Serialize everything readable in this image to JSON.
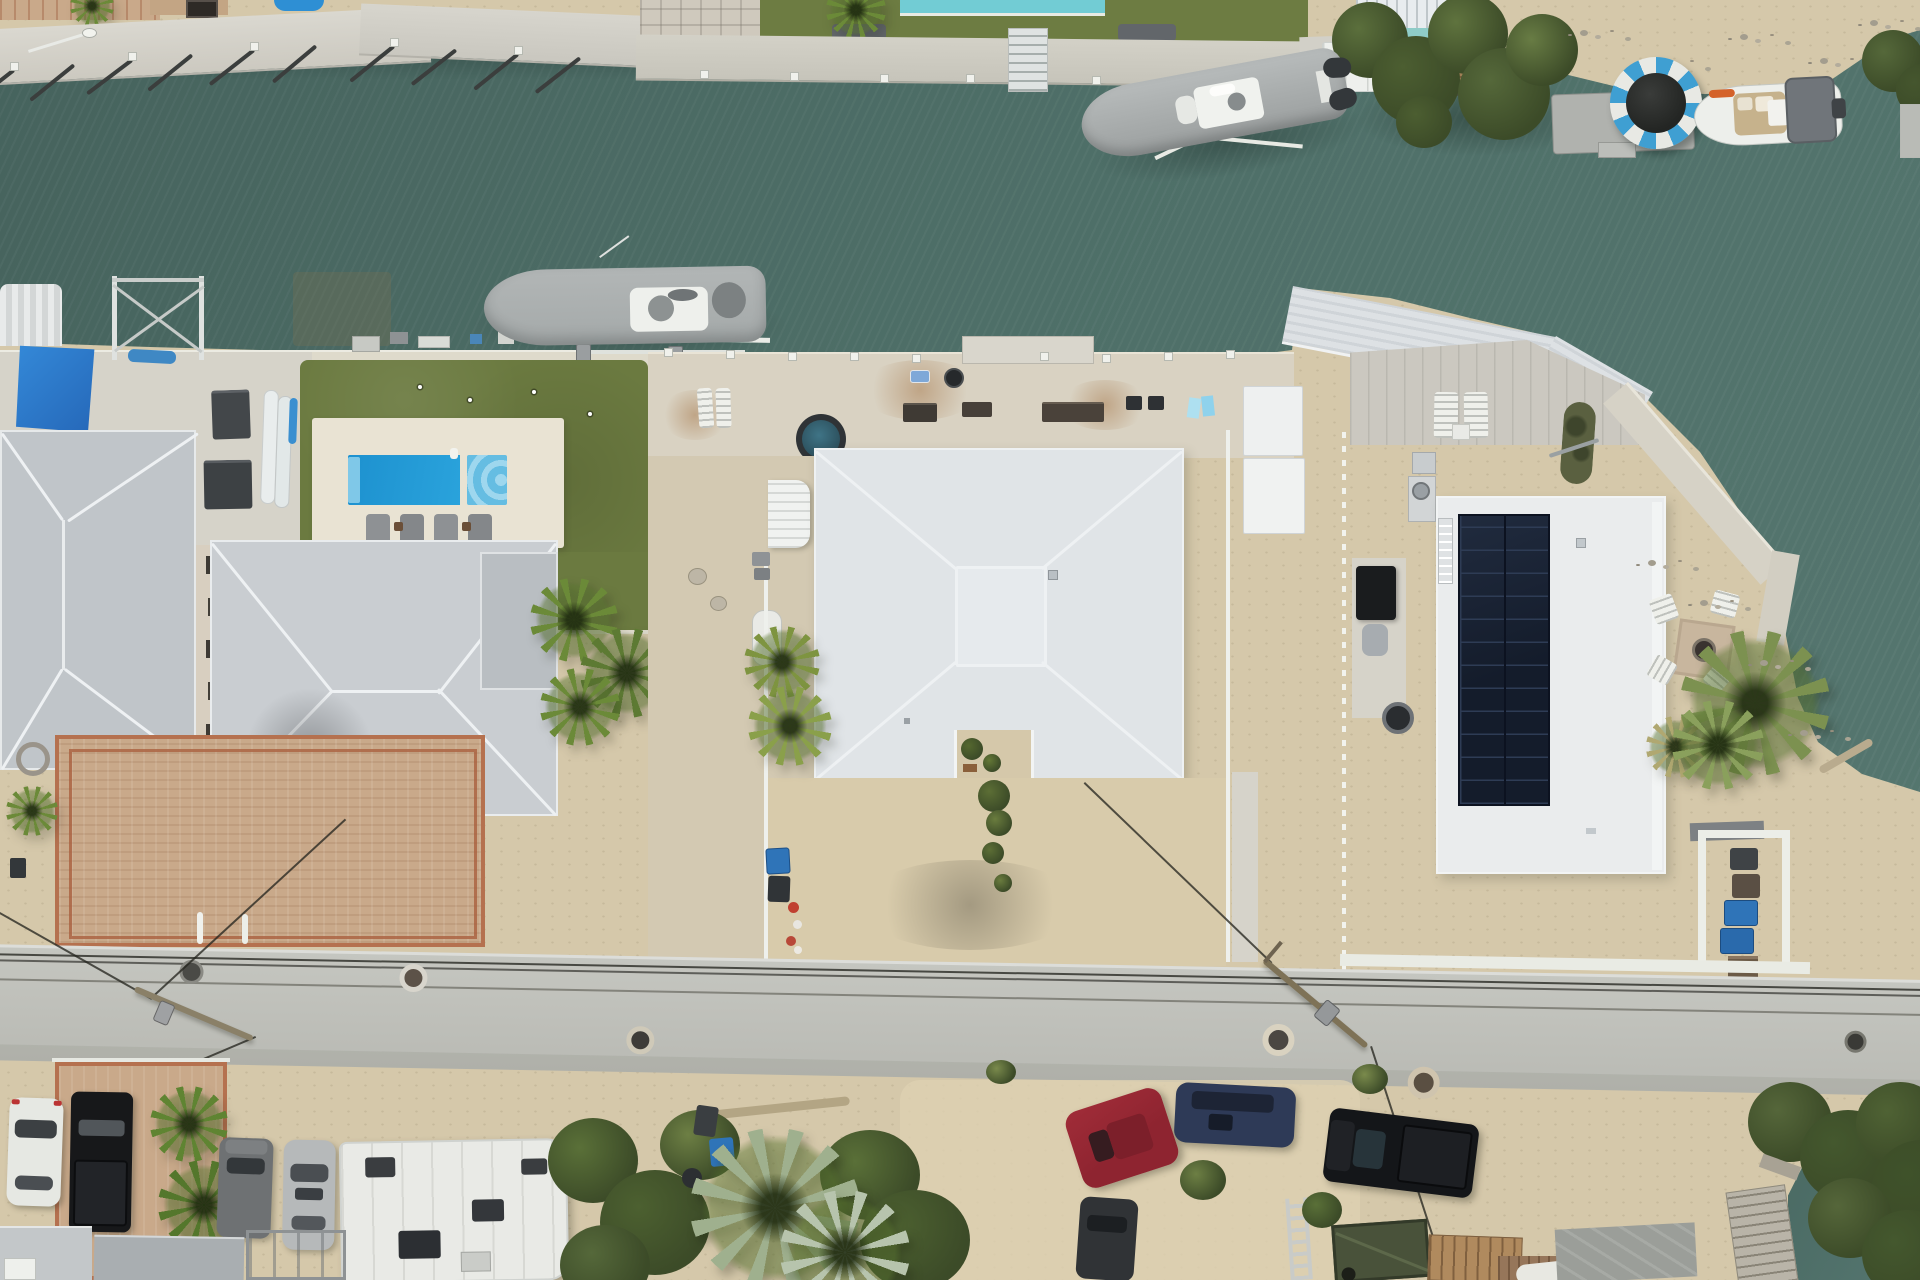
{
  "scene": {
    "kind": "aerial-drone-photo",
    "setting": "waterfront canal neighborhood with three properties, docks, boats, pool, solar roof, road and parked vehicles"
  },
  "palette": {
    "water": "#4e6f68",
    "waterDark": "#46635d",
    "waterLight": "#567770",
    "sand": "#d5c8aa",
    "sandBright": "#ddd1b2",
    "gravel": "#cdc3ad",
    "concrete": "#d9d2c2",
    "seawall": "#d6d3c9",
    "poolDeck": "#e9e3d3",
    "road": "#c5c6c0",
    "turf": "#6b7a40",
    "lawn": "#6d7c42",
    "pool": "#2196d2",
    "spa": "#65bde2",
    "neighborPool": "#72ccd4",
    "shadeSail": "#2b7fd0",
    "roofGray": "#c0c5c9",
    "roofGrayLight": "#c9cdd1",
    "roofWhite": "#e0e4e7",
    "roofSolarBase": "#eaeced",
    "solarPanel": "#141c2b",
    "solarGrid": "#2e3c55",
    "boatCover": "#a4a9a9",
    "hullWhite": "#edefeb",
    "trampBlue": "#3f9fd2",
    "trampWhite": "#e8e9e4",
    "trampMat": "#232523",
    "palmGreen": "#5d7a33",
    "palmBright": "#6b8a38",
    "palmSilver": "#9fb08e",
    "mangrove": "#4c5e31",
    "brick": "#c9a98a",
    "brickLine": "#b5714f",
    "carWhite": "#e6e8e3",
    "carBlack": "#17181a",
    "carGray": "#6e7173",
    "carSilver": "#b6b9ba",
    "carRed": "#8e2430",
    "carNavy": "#2e3a57",
    "trailerGreen": "#49523a",
    "binBlue": "#2f74b8",
    "binDark": "#303437",
    "wood": "#a08056",
    "deckWood": "#b08a5e"
  },
  "objects": [
    "canal",
    "north-docks",
    "covered-boat-on-lift-center",
    "covered-boat-on-lift-right",
    "water-trampoline",
    "small-moored-boat",
    "left-house",
    "left-center-house",
    "pool-with-spa",
    "putting-green",
    "blue-shade-sail",
    "middle-white-hip-roof-house",
    "solar-panel-house",
    "palm-trees",
    "street",
    "fallen-utility-poles",
    "parked-vehicles",
    "rv-trailer",
    "trash-bins",
    "mangroves"
  ]
}
